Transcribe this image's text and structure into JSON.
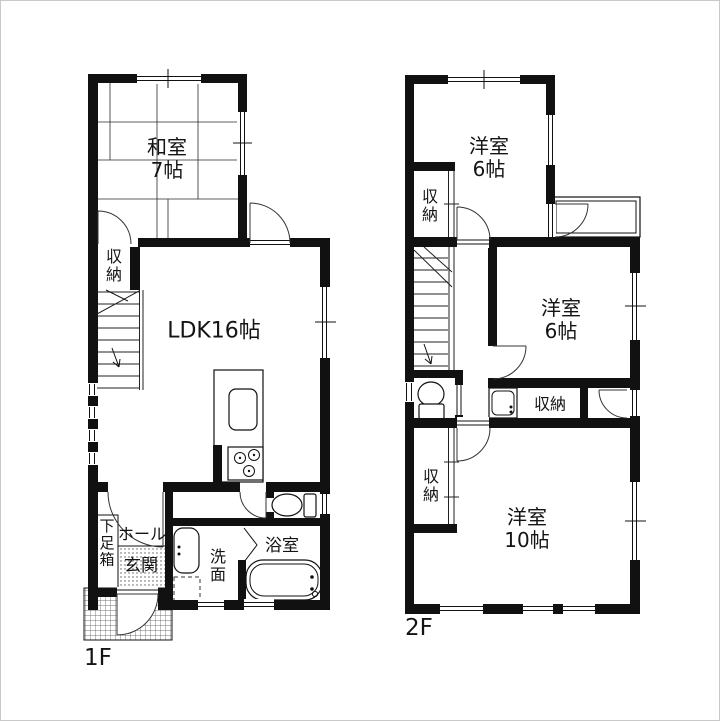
{
  "page": {
    "background": "#ffffff",
    "line_color": "#111111",
    "border_color": "#c9c9c9"
  },
  "floors": [
    {
      "label": "1F",
      "rooms": {
        "washitsu": {
          "name": "和室",
          "size": "7帖"
        },
        "ldk": {
          "name": "LDK16帖"
        },
        "closet": {
          "name": "収納"
        },
        "shoe_cabinet": {
          "name": "下足箱"
        },
        "hall": {
          "name": "ホール"
        },
        "entrance": {
          "name": "玄関"
        },
        "washroom": {
          "name": "洗面"
        },
        "bathroom": {
          "name": "浴室"
        }
      }
    },
    {
      "label": "2F",
      "rooms": {
        "bedroom_a": {
          "name": "洋室",
          "size": "6帖"
        },
        "closet_a": {
          "name": "収納"
        },
        "bedroom_b": {
          "name": "洋室",
          "size": "6帖"
        },
        "closet_b": {
          "name": "収納"
        },
        "closet_c": {
          "name": "収納"
        },
        "bedroom_c": {
          "name": "洋室",
          "size": "10帖"
        }
      }
    }
  ]
}
